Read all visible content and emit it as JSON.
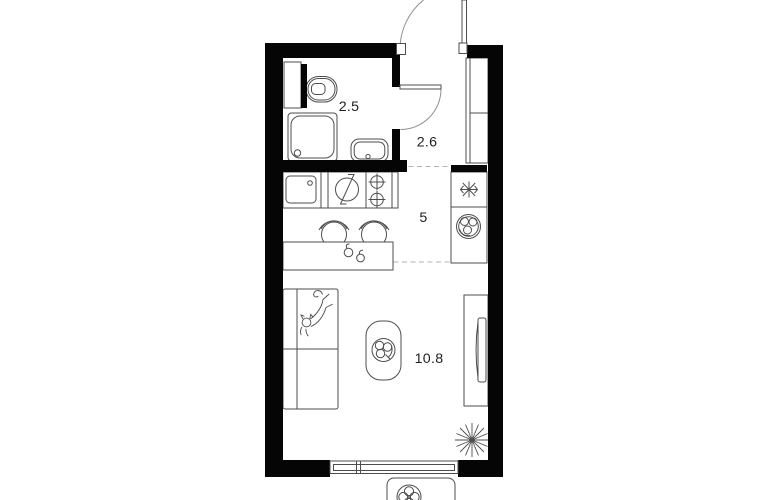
{
  "plan_title": "studio apartment floor plan",
  "rooms": [
    {
      "id": "bathroom",
      "area": "2.5"
    },
    {
      "id": "hallway",
      "area": "2.6"
    },
    {
      "id": "kitchen",
      "area": "5"
    },
    {
      "id": "living-room",
      "area": "10.8"
    }
  ],
  "icons": {
    "bathroom": [
      "toilet-icon",
      "shower-cabin-icon",
      "washbasin-icon",
      "vent-shaft"
    ],
    "hallway": [
      "wardrobe",
      "interior-door",
      "entrance-door"
    ],
    "kitchen": [
      "kitchen-sink-icon",
      "washing-machine-icon",
      "cooktop-burner-icon",
      "bar-counter",
      "chair-icon",
      "fridge-snowflake-icon",
      "appliance-drum-icon"
    ],
    "living_room": [
      "sofa-bed",
      "cat-icon",
      "coffee-table",
      "plant-icon",
      "tv-stand",
      "tv-icon",
      "plant-starburst-icon"
    ],
    "balcony": [
      "ac-fan-icon"
    ],
    "window": [
      "window-frame"
    ]
  },
  "colors": {
    "background": "#ffffff",
    "wall": "#050505",
    "line": "#4d4d4d",
    "arc": "#8f8f8f",
    "dash": "#b3b3b3",
    "text": "#1f1f1f"
  }
}
